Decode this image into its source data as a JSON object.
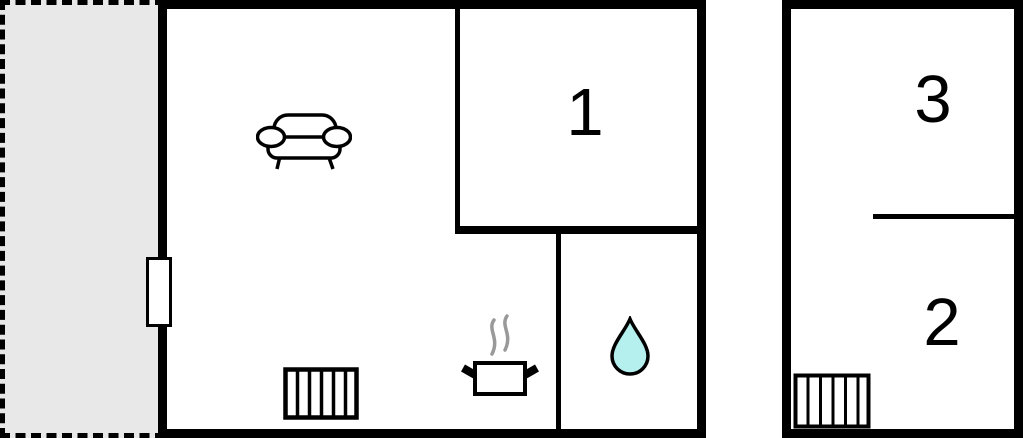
{
  "colors": {
    "background": "#ffffff",
    "walls": "#000000",
    "terrace_fill": "#e8e8e8",
    "water_drop_fill": "#b5f0ef",
    "steam": "#999999"
  },
  "rooms": [
    {
      "id": "room-1",
      "label": "1",
      "building": "main"
    },
    {
      "id": "room-3",
      "label": "3",
      "building": "annex"
    },
    {
      "id": "room-2",
      "label": "2",
      "building": "annex"
    }
  ],
  "icons": {
    "sofa": "sofa-icon",
    "radiator_main": "radiator-icon",
    "stove": "steaming-pot-icon",
    "water_drop": "water-drop-icon",
    "radiator_annex": "radiator-icon",
    "window": "window-door-marker"
  }
}
